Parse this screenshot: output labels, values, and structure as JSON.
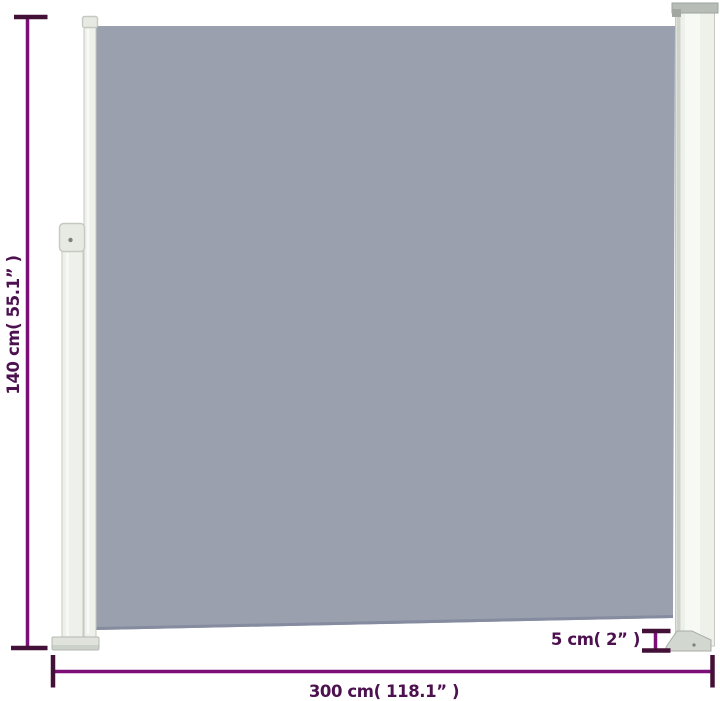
{
  "labels": {
    "height": "140 cm( 55.1” )",
    "width": "300 cm( 118.1” )",
    "post_depth": "5 cm( 2” )"
  },
  "measurements": {
    "height_cm": "140",
    "height_in": "55.1",
    "width_cm": "300",
    "width_in": "118.1",
    "post_depth_cm": "5",
    "post_depth_in": "2"
  },
  "colors": {
    "background": "#ffffff",
    "fabric": "#9aa0ae",
    "fabric_hem": "#868ca0",
    "frame_fill": "#eef0ea",
    "frame_cap": "#e7eae3",
    "frame_stroke": "#c5c9c2",
    "frame_shade": "#ced3cc",
    "frame_hilite": "#f9faf7",
    "post_cap": "#b7bcb6",
    "post_cap_stroke": "#9ea49d",
    "post_foot": "#d2d7d0",
    "post_foot_stroke": "#a9aea8",
    "screw": "#7c827b",
    "dim_line": "#7c0e78",
    "dim_cap": "#431037",
    "dim_text": "#4d1150"
  }
}
